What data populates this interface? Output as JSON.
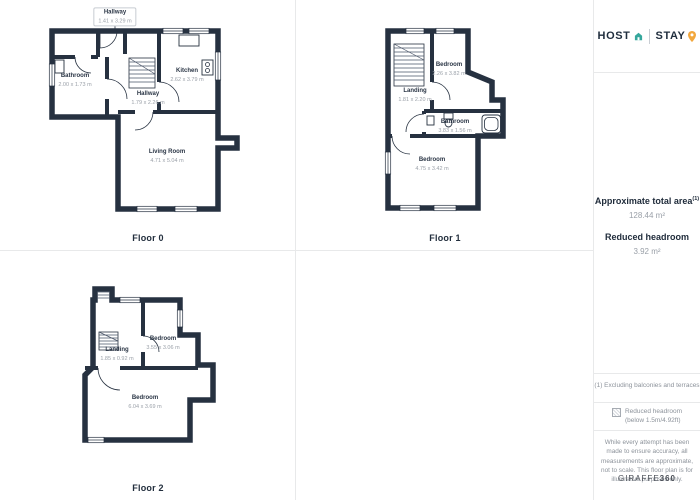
{
  "floors": {
    "floor0": {
      "label": "Floor 0",
      "rooms": [
        {
          "name": "Hallway",
          "dims": "1.41 x 3.29 m"
        },
        {
          "name": "Bathroom",
          "dims": "2.00 x 1.73 m"
        },
        {
          "name": "Kitchen",
          "dims": "2.62 x 3.79 m"
        },
        {
          "name": "Hallway",
          "dims": "1.79 x 2.26 m"
        },
        {
          "name": "Living Room",
          "dims": "4.71 x 5.04 m"
        }
      ]
    },
    "floor1": {
      "label": "Floor 1",
      "rooms": [
        {
          "name": "Bedroom",
          "dims": "2.26 x 3.82 m"
        },
        {
          "name": "Landing",
          "dims": "1.81 x 2.20 m"
        },
        {
          "name": "Bathroom",
          "dims": "3.83 x 1.56 m"
        },
        {
          "name": "Bedroom",
          "dims": "4.75 x 3.42 m"
        }
      ]
    },
    "floor2": {
      "label": "Floor 2",
      "rooms": [
        {
          "name": "Landing",
          "dims": "1.85 x 0.92 m"
        },
        {
          "name": "Bedroom",
          "dims": "3.55 x 3.06 m"
        },
        {
          "name": "Bedroom",
          "dims": "6.04 x 3.69 m"
        }
      ]
    }
  },
  "sidebar": {
    "logo": {
      "host": "HOST",
      "stay": "STAY"
    },
    "area": {
      "total_label": "Approximate total area",
      "total_sup": "(1)",
      "total_value": "128.44 m²",
      "reduced_label": "Reduced headroom",
      "reduced_value": "3.92 m²"
    },
    "footnote": "(1) Excluding balconies and terraces",
    "legend": {
      "label": "Reduced headroom",
      "sublabel": "(below 1.5m/4.92ft)"
    },
    "disclaimer": "While every attempt has been made to ensure accuracy, all measurements are approximate, not to scale. This floor plan is for illustrative purposes only.",
    "brand": {
      "name": "GIRAFFE",
      "suffix": "360"
    }
  },
  "colors": {
    "wall": "#263140",
    "accent_teal": "#35a79c",
    "accent_orange": "#f2a73d",
    "divider": "#e8e9ea",
    "text_dark": "#212d3c",
    "text_muted": "#9aa0a8"
  }
}
